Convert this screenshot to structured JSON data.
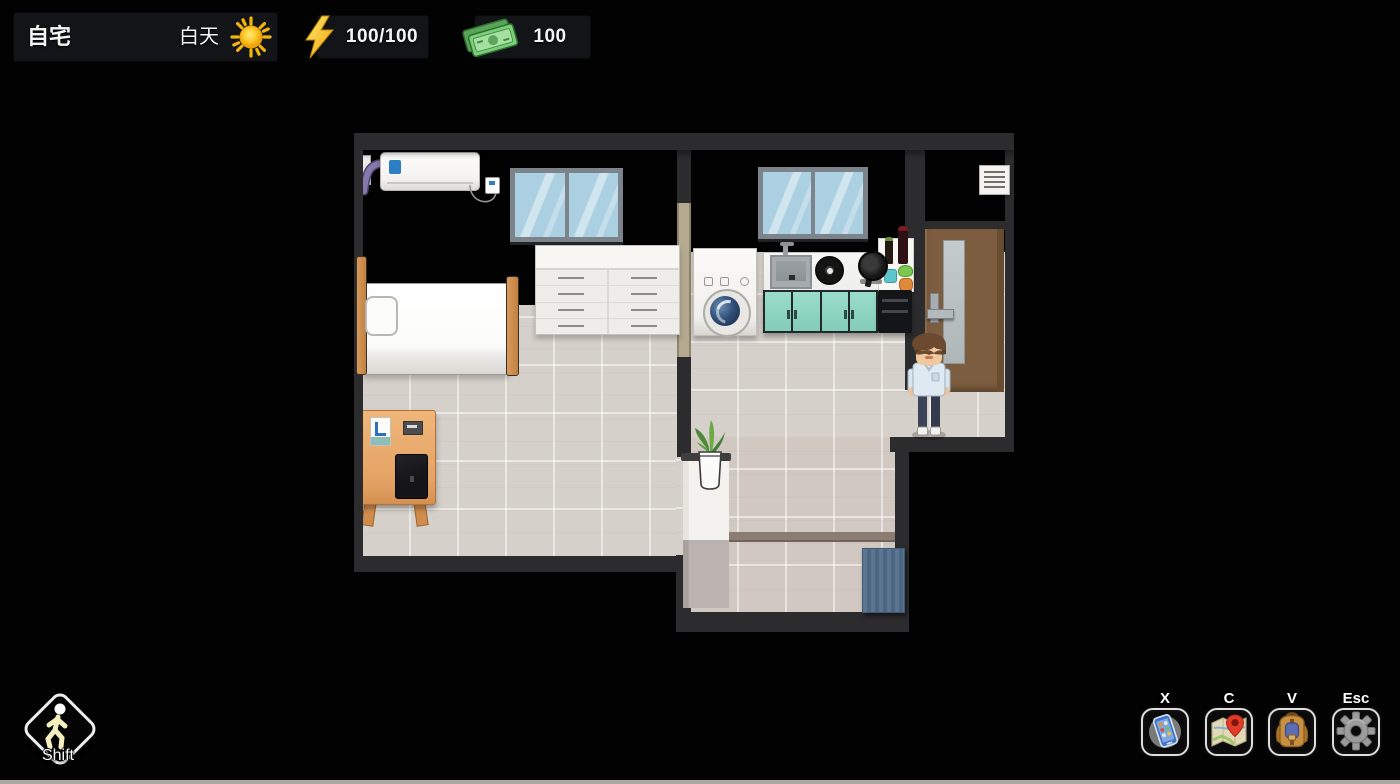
{
  "window": {
    "width": 1400,
    "height": 784
  },
  "hud": {
    "location": {
      "label": "自宅"
    },
    "time": {
      "label": "白天",
      "icon": "sun-icon"
    },
    "energy": {
      "value": "100/100",
      "icon": "lightning-icon"
    },
    "money": {
      "value": "100",
      "icon": "banknote-icon"
    }
  },
  "movement_indicator": {
    "label": "Shift",
    "icon": "walking-person-icon"
  },
  "hotkeys": [
    {
      "key": "X",
      "action": "phone",
      "icon": "phone-icon"
    },
    {
      "key": "C",
      "action": "map",
      "icon": "map-pin-icon"
    },
    {
      "key": "V",
      "action": "inventory",
      "icon": "backpack-icon"
    },
    {
      "key": "Esc",
      "action": "settings",
      "icon": "gear-icon"
    }
  ],
  "scene": {
    "name": "apartment-interior",
    "rooms": [
      "bedroom",
      "kitchen",
      "living-area",
      "entry-hall"
    ],
    "objects": [
      "air-conditioner",
      "ac-remote",
      "bedroom-window",
      "kitchen-window",
      "dresser",
      "bed",
      "desk",
      "laptop",
      "notepad",
      "washing-machine",
      "kitchen-sink",
      "stove-burner",
      "wok-pan",
      "bottles-and-vegetables",
      "teal-cabinets",
      "dishwasher",
      "wall-vent",
      "entry-door",
      "potted-plant",
      "shoe-cabinet",
      "doormat"
    ],
    "player": {
      "position": "front-of-entry-door"
    }
  },
  "colors": {
    "background": "#000000",
    "hud_panel": "#15171b",
    "wall_cap": "#2c2c2e",
    "bedroom_wall": "#c4b9a2",
    "kitchen_wall": "#d7cdb8",
    "floor_tile": "#d6d0ca",
    "hall_tile": "#d2c8c2",
    "cabinet_teal": "#8ed6c3",
    "door_brown": "#7d5d3f",
    "doormat_blue": "#55718a",
    "desk_wood": "#e4a365",
    "accent_yellow": "#f6b40e",
    "money_green": "#7ccf7a"
  }
}
